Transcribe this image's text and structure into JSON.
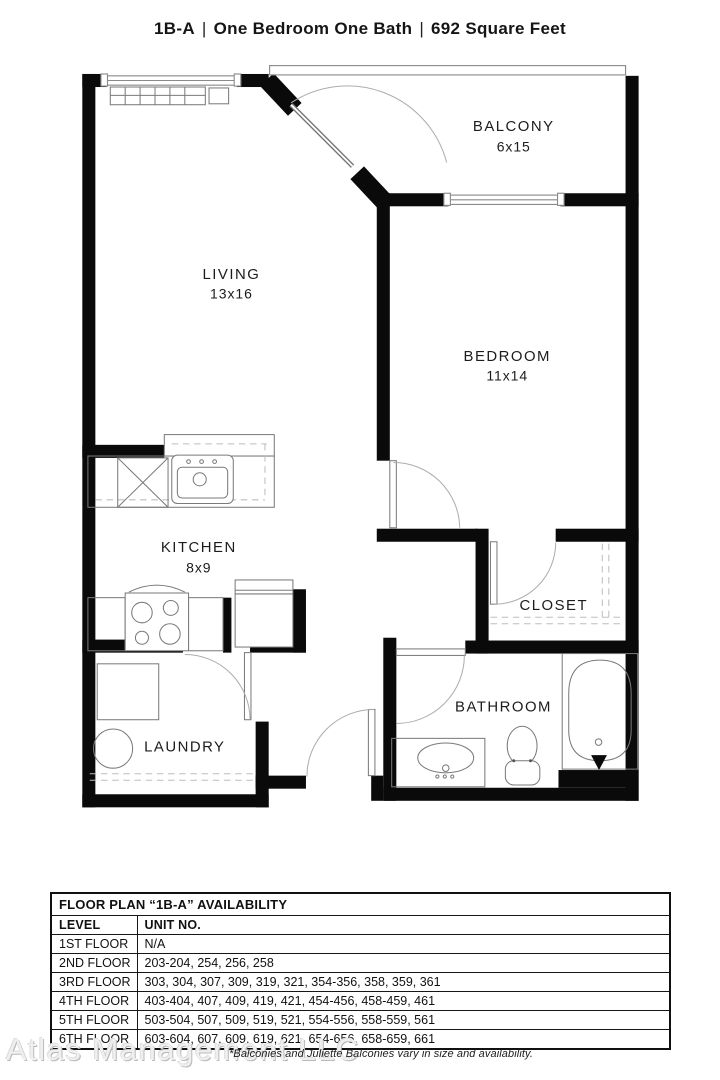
{
  "title": {
    "plan_code": "1B-A",
    "description": "One Bedroom One Bath",
    "area": "692 Square Feet",
    "separator": "|"
  },
  "floor_plan": {
    "rooms": [
      {
        "name": "BALCONY",
        "dimensions": "6x15"
      },
      {
        "name": "LIVING",
        "dimensions": "13x16"
      },
      {
        "name": "BEDROOM",
        "dimensions": "11x14"
      },
      {
        "name": "KITCHEN",
        "dimensions": "8x9"
      },
      {
        "name": "CLOSET",
        "dimensions": ""
      },
      {
        "name": "BATHROOM",
        "dimensions": ""
      },
      {
        "name": "LAUNDRY",
        "dimensions": ""
      }
    ],
    "colors": {
      "walls": "#0a0a0a",
      "thin_lines": "#8a8a8a",
      "labels": "#1c1c1c"
    }
  },
  "availability_table": {
    "title": "FLOOR PLAN “1B-A” AVAILABILITY",
    "columns": {
      "level": "LEVEL",
      "units": "UNIT NO."
    },
    "rows": [
      {
        "level": "1ST FLOOR",
        "units": "N/A"
      },
      {
        "level": "2ND FLOOR",
        "units": "203-204, 254, 256, 258"
      },
      {
        "level": "3RD FLOOR",
        "units": "303, 304, 307, 309, 319, 321, 354-356, 358, 359, 361"
      },
      {
        "level": "4TH FLOOR",
        "units": "403-404, 407, 409, 419, 421, 454-456, 458-459, 461"
      },
      {
        "level": "5TH FLOOR",
        "units": "503-504, 507, 509, 519, 521, 554-556, 558-559, 561"
      },
      {
        "level": "6TH FLOOR",
        "units": "603-604, 607, 609, 619, 621, 654-656, 658-659, 661"
      }
    ]
  },
  "footer": {
    "watermark": "Atlas Management LLC",
    "note": "*Balconies and Juliette Balconies vary in size and availability."
  }
}
